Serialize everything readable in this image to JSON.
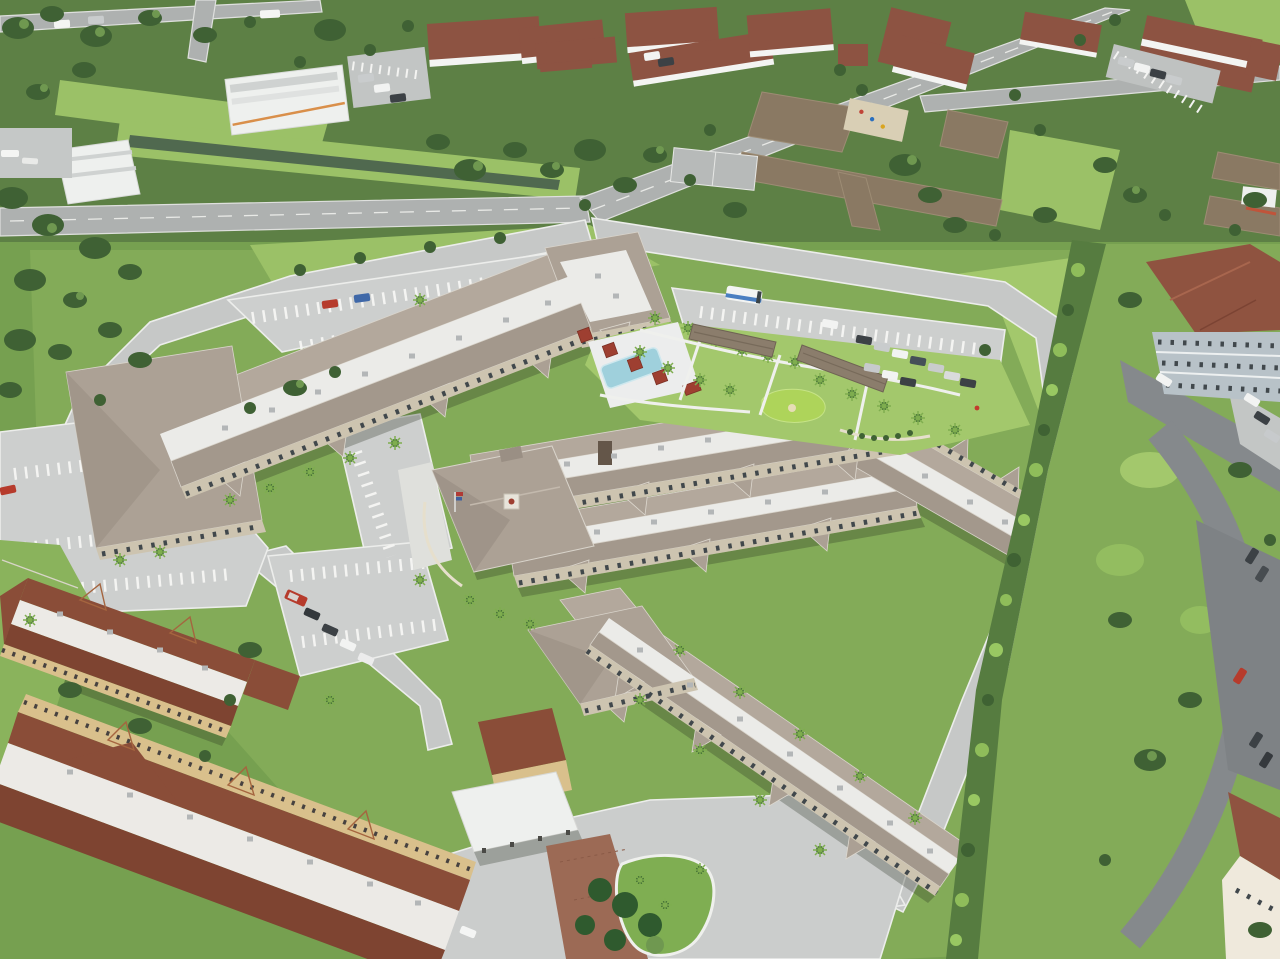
{
  "image": {
    "type": "aerial drone photograph",
    "view": "oblique top-down view of a suburban residential development on a bright sunny day",
    "description": "Large three-story tan apartment / senior-living complex with taupe tile hip roofs and white reflective flat-roof strips, arranged as connected zig-zag wings around landscaped courtyards. A two-story clubhouse with cupola and flagpole sits mid-site. Surroundings include public roads, a canal, white condominiums with terracotta roofs, a brown-roofed campus, dense tree cover, carports, parking lots with cars, and two long yellow apartment buildings with terracotta roofs in the lower left.",
    "visible_text": "none"
  },
  "main_complex": {
    "label": "three-story residential complex",
    "features": [
      "connected residential wings with repeating gables",
      "white flat roof strips with rooftop AC units",
      "tan stucco walls with cream trim and dark windows",
      "two-story clubhouse with cupola and flagpole",
      "central courtyard with lawn and palms",
      "narrow lap pool with sun deck",
      "red shade pergolas",
      "putting green with sand bunker",
      "white walking paths",
      "detached carport canopies",
      "striped surface parking lots",
      "entry drive with teardrop grass island",
      "brick paver entry apron",
      "porte-cochere canopy"
    ]
  },
  "surroundings": {
    "north": [
      "divided public road",
      "drainage canal",
      "white commercial buildings",
      "car lot",
      "white condominiums with terracotta hip roofs",
      "single-story campus with brown shingle roofs",
      "playground",
      "basketball court",
      "green playfield"
    ],
    "east": [
      "tall hedge and tree line",
      "blue-gray condominium with terracotta roof",
      "dark asphalt drives and parking",
      "bright lawns"
    ],
    "southwest": [
      "two long yellow apartment buildings with terracotta tile roofs and white flat roofs",
      "guest parking with red van",
      "tropical garden",
      "entrance drive"
    ]
  },
  "vehicles": {
    "shuttle_bus": "white mini-bus with blue skirt stripe in the north lot",
    "cars_visible_approx": 34,
    "notable": [
      "red hatchback and blue sedan in the north lot",
      "rows of gray, white and dark cars in the east lot",
      "red van and four cars in the southwest lot",
      "white sedan on the south entry drive",
      "red car on the east neighbor road",
      "blue boat under the south carport"
    ],
    "pedestrians": "one person in red near the east lot"
  },
  "palette": {
    "ground": "#76a050",
    "grass": "#83ab58",
    "lawn_light": "#9bc167",
    "lawn_bright": "#a3c86c",
    "canopy": "#3f6134",
    "canopy_light": "#6f9850",
    "hedge": "#567c40",
    "canal": "#50694f",
    "road_public": "#aeb1b0",
    "road": "#c6c8c7",
    "parking": "#cdcfce",
    "asphalt": "#85898c",
    "concrete": "#cbcdcc",
    "flat_roof": "#ebebe8",
    "flat_roof_b": "#eceae6",
    "roof_taupe": "#b3a89c",
    "roof_taupe_mid": "#aba094",
    "roof_taupe_dark": "#a3988c",
    "roof_hip": "#aca195",
    "wall_tan": "#cdc4b0",
    "wall_yellow": "#d9c08c",
    "condo_red": "#8d5342",
    "roof_rust": "#8a4d38",
    "roof_rust_dark": "#7e4431",
    "roof_neighbor": "#8f5340",
    "roof_brown": "#8a7963",
    "carport": "#8b7d6c",
    "wall_white": "#eef0ee",
    "wall_bluegray": "#b8c2c8",
    "pool": "#9fd0dc",
    "pool_deck": "#eceded",
    "putting_green": "#aed45a",
    "pergola_red": "#9e3f31",
    "island_green": "#7fae52",
    "brick": "#9c6a55",
    "car_red": "#b63b2c",
    "car_blue": "#3f68a8",
    "bus_blue": "#4a7fc1",
    "boat_blue": "#3f6fb5",
    "playground_sand": "#d9cfb5"
  }
}
